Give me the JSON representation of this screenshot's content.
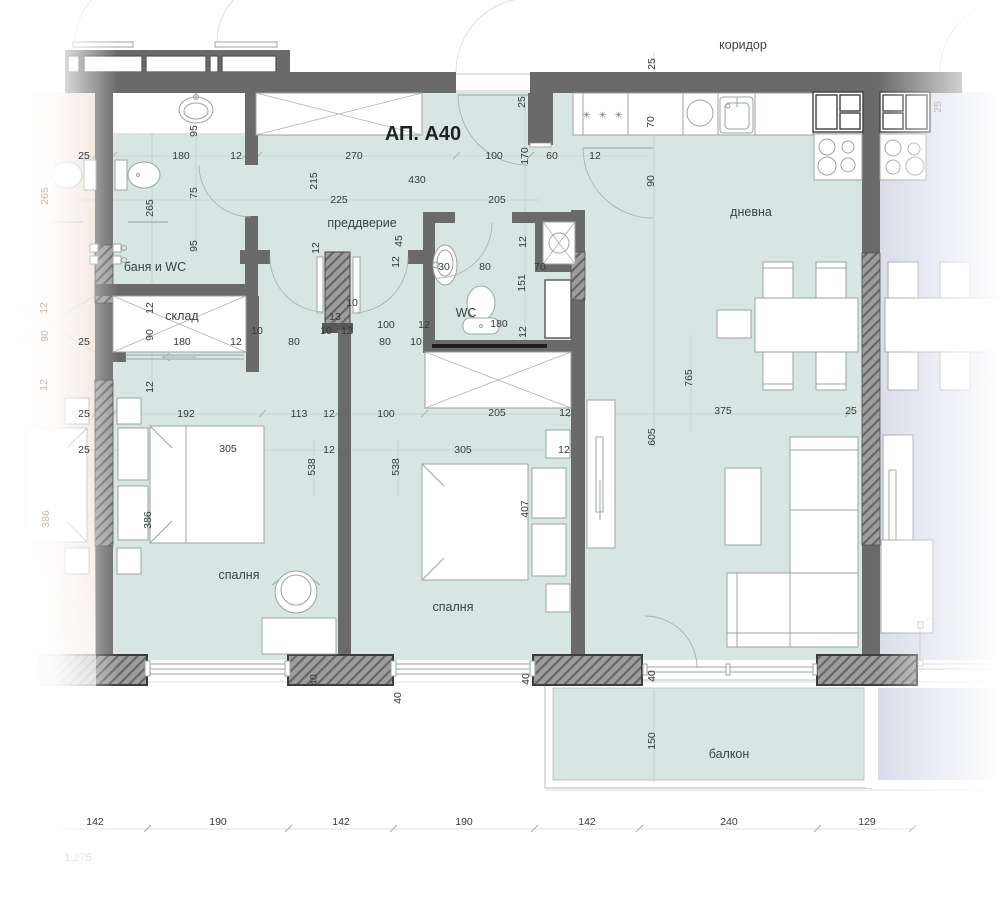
{
  "title": "АП. А40",
  "rooms": {
    "corridor": "коридор",
    "bath": "баня и WC",
    "storage": "склад",
    "hall": "преддверие",
    "wc": "WC",
    "living": "дневна",
    "bedroom1": "спалня",
    "bedroom2": "спалня",
    "balcony": "балкон"
  },
  "kitchen": {
    "burner_symbols": "✳ ✳ ✳"
  },
  "dims": {
    "row_top": [
      "25",
      "180",
      "12",
      "270",
      "100",
      "170",
      "60",
      "12"
    ],
    "upper": [
      "95",
      "215",
      "430",
      "225",
      "205",
      "265",
      "75",
      "95"
    ],
    "kitchen": [
      "25",
      "25",
      "70",
      "90",
      "25"
    ],
    "wc": [
      "45",
      "12",
      "12",
      "30",
      "80",
      "70",
      "151",
      "180",
      "12"
    ],
    "hall": [
      "12",
      "13",
      "10",
      "10",
      "12",
      "100",
      "80",
      "12",
      "10",
      "80",
      "10"
    ],
    "storage": [
      "12",
      "90",
      "180",
      "12",
      "25",
      "12"
    ],
    "mid": [
      "25",
      "192",
      "113",
      "12",
      "100",
      "205",
      "12",
      "375",
      "25"
    ],
    "living": [
      "765",
      "605"
    ],
    "beds": [
      "25",
      "305",
      "12",
      "538",
      "538",
      "305",
      "12",
      "386",
      "407"
    ],
    "wall40": [
      "40",
      "40",
      "40",
      "40"
    ],
    "balcony": [
      "150"
    ],
    "left_faded": [
      "265",
      "12",
      "90",
      "12",
      "386"
    ],
    "bottom_row": [
      "142",
      "190",
      "142",
      "190",
      "142",
      "240",
      "129"
    ],
    "note": "1.275"
  },
  "colors": {
    "floor": "#d8e6e3",
    "balcony_floor": "#d8e6e3",
    "neighbor_left": "#f0e1d5",
    "neighbor_right": "#d9dde9",
    "wall": "#6a6a6a",
    "wall_dark": "#3f3f3f",
    "hatch": "#9d9d9d"
  }
}
